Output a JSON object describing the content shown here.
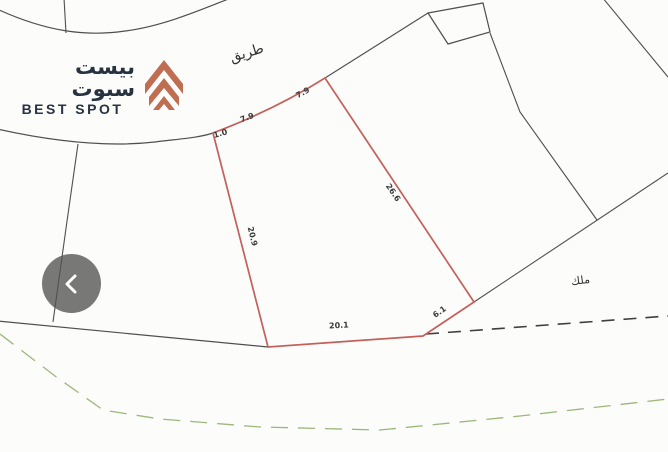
{
  "logo": {
    "arabic_name": "بيست سبوت",
    "latin_name": "BEST SPOT",
    "accent_color": "#bf6e52",
    "text_color": "#273341"
  },
  "map": {
    "road_label": "طريق",
    "owner_label": "ملك",
    "plot_color": "#c4605a",
    "line_color": "#4f4f4f",
    "green_line_color": "#9cb77c",
    "dimensions": {
      "top_corner": "1.0",
      "top_left": "7.9",
      "top_right": "7.9",
      "left_side": "20.9",
      "right_side": "26.6",
      "bottom_side": "20.1",
      "bottom_right_side": "6.1"
    }
  },
  "controls": {
    "prev_button_glyph": "‹"
  }
}
